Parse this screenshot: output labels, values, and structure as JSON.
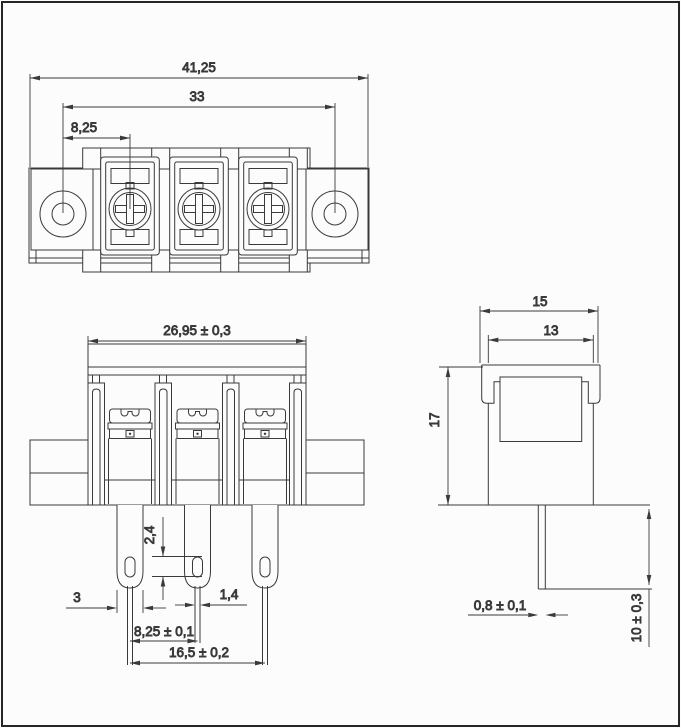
{
  "drawing": {
    "type": "engineering-drawing",
    "subject": "3-pole barrier terminal block, three orthographic views",
    "line_color": "#3a3a3a",
    "background": "#fcfcfc",
    "top_view": {
      "overall_width": "41,25",
      "mounting_hole_spacing": "33",
      "terminal_pitch": "8,25"
    },
    "front_view": {
      "housing_width": "26,95 ± 0,3",
      "pin_hole_length": "2,4",
      "pin_width": "3",
      "pin_tail_width": "1,4",
      "pin_pitch": "8,25 ± 0,1",
      "outer_pin_spacing": "16,5 ± 0,2"
    },
    "side_view": {
      "cap_width": "15",
      "body_depth": "13",
      "housing_height": "17",
      "pin_thickness": "0,8 ± 0,1",
      "pin_length_below": "10 ± 0,3"
    }
  }
}
